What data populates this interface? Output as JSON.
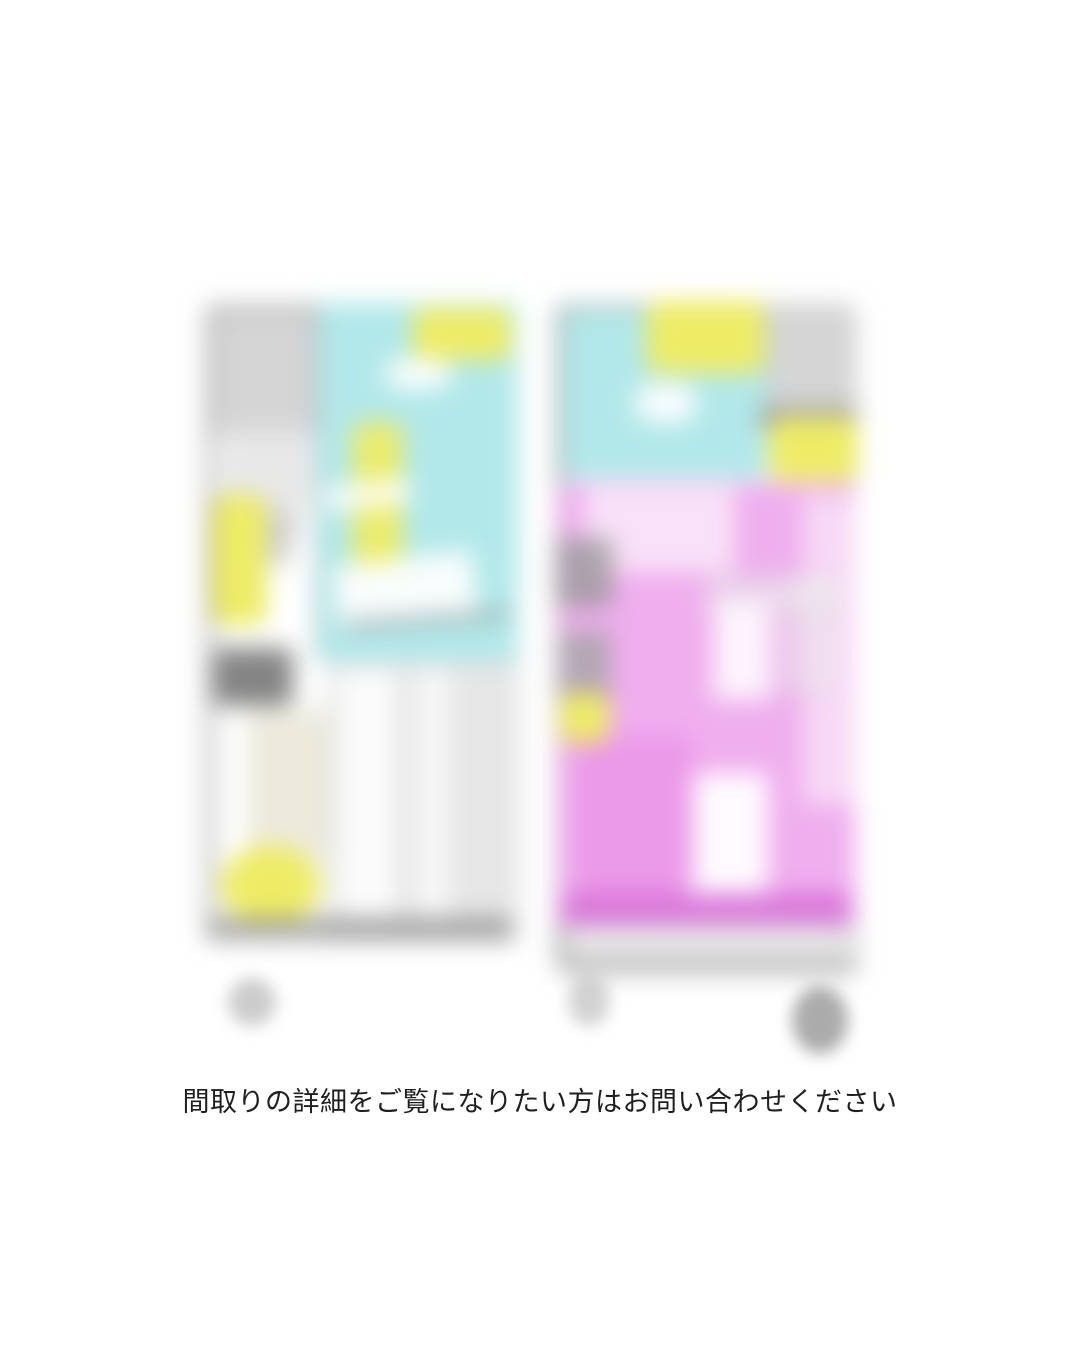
{
  "page": {
    "background": "#ffffff",
    "caption": "間取りの詳細をご覧になりたい方はお問い合わせください",
    "caption_color": "#1f1f1f"
  },
  "colors": {
    "page_bg": "#ffffff",
    "cyan_room": "#b2e8e9",
    "yellow_highlight": "#eeec66",
    "pink_room": "#efaeee",
    "pink_room_light": "#f9e4f8",
    "pink_room_deep": "#d66fd6",
    "wall_gray": "#7a7a7a",
    "texture_gray": "#b5b5b5",
    "smudge_gray": "#8f8f8f"
  }
}
